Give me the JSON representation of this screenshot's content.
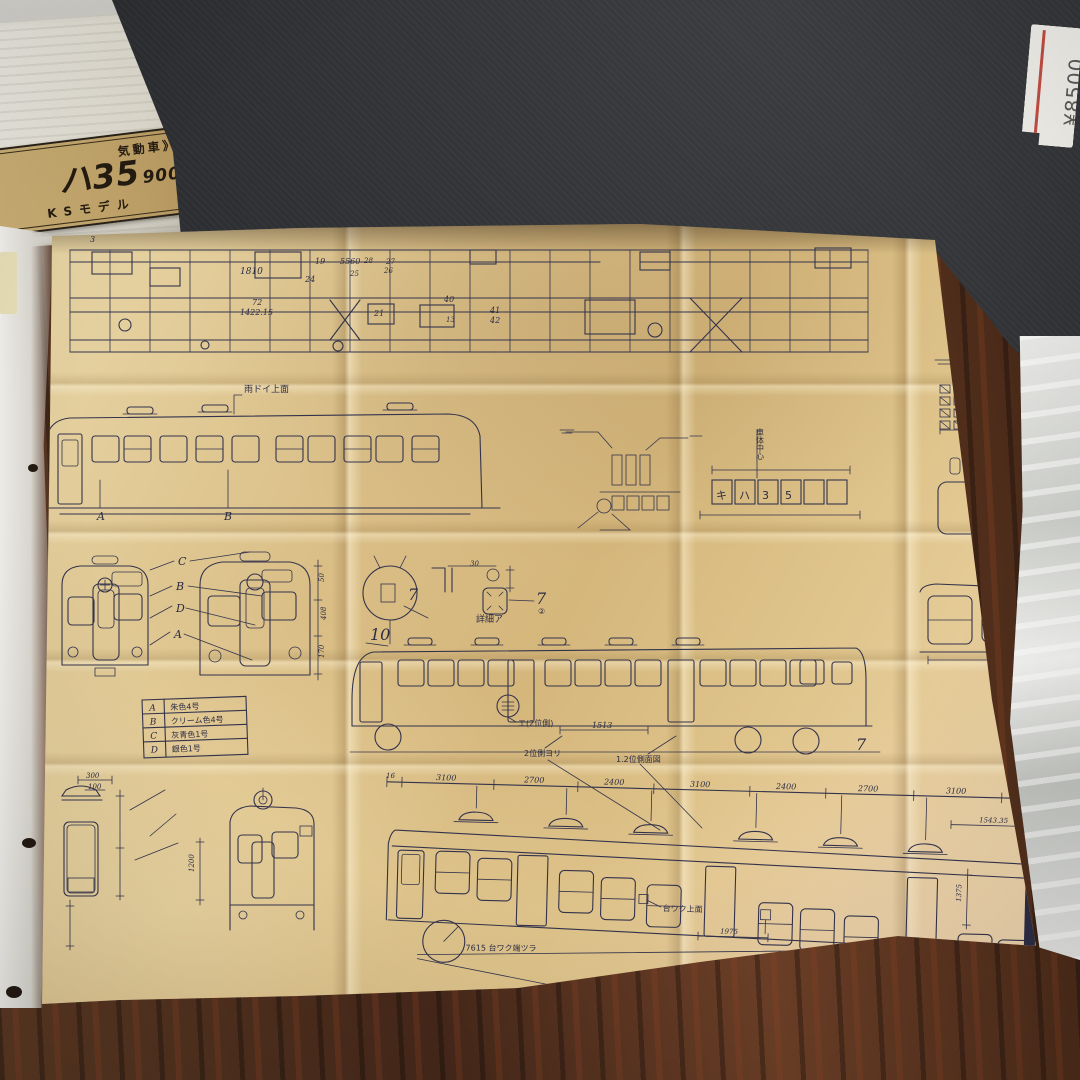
{
  "scene": {
    "box_label": {
      "series": "気動車》",
      "model": "ハ35",
      "model_sub": "900",
      "maker": "KSモデル"
    },
    "price_tag": {
      "price": "¥8500"
    },
    "paper_color": "#d9bd85",
    "ink_color": "#33334c"
  },
  "legend": {
    "rows": [
      {
        "key": "A",
        "color": "朱色4号"
      },
      {
        "key": "B",
        "color": "クリーム色4号"
      },
      {
        "key": "C",
        "color": "灰青色1号"
      },
      {
        "key": "D",
        "color": "銀色1号"
      }
    ]
  },
  "bp": {
    "tp": {
      "a": "3",
      "b": "1810",
      "c": "19",
      "d": "24",
      "e": "5560",
      "f": "25",
      "g": "28",
      "h": "27",
      "i": "26",
      "j": "72",
      "k": "1422.15",
      "l": "21",
      "m": "40",
      "n": "41",
      "o": "42",
      "p": "13"
    },
    "ml": {
      "gutter": "雨ドイ上面",
      "a": "A",
      "b": "B"
    },
    "lt": {
      "c1": "キ",
      "c2": "ハ",
      "c3": "3",
      "c4": "5",
      "center": "車体中心",
      "d30": "30"
    },
    "dt": {
      "s7a": "7",
      "s7b": "7",
      "c2": "②",
      "detail": "詳細ア",
      "n10": "10",
      "n8": "8",
      "c1": "①",
      "ka": "カ",
      "e2": "エ(2位側)"
    },
    "fv": {
      "c": "C",
      "b": "B",
      "d": "D",
      "a": "A",
      "d50": "50",
      "d408": "408",
      "d170": "170"
    },
    "me": {
      "pos2": "2位側ヨリ",
      "side": "1.2位側面図",
      "d1513": "1513",
      "s7": "7"
    },
    "be": {
      "dims": [
        "16",
        "3100",
        "2700",
        "2400",
        "3100",
        "2400",
        "2700",
        "3100"
      ],
      "sub": "1543.35",
      "sub2": "16",
      "ft1": "台ワク上面",
      "ft2": "台ワク上面",
      "edge": "7615 台ワク端ツラ",
      "d1975": "1975",
      "d1375": "1375"
    },
    "bl": {
      "d300": "300",
      "d100": "100",
      "d1200": "1200"
    }
  }
}
